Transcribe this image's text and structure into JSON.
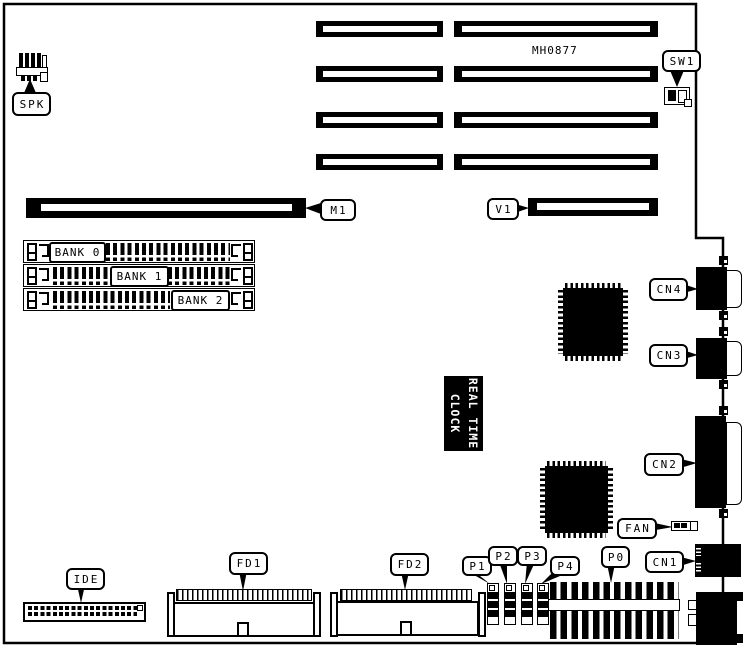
{
  "figure": {
    "board_code": "MH0877",
    "rtc": {
      "line1": "REAL TIME",
      "line2": "CLOCK"
    },
    "connector_labels": {
      "spk": "SPK",
      "sw1": "SW1",
      "m1": "M1",
      "v1": "V1",
      "cn4": "CN4",
      "cn3": "CN3",
      "cn2": "CN2",
      "cn1": "CN1",
      "fan": "FAN",
      "p0": "P0",
      "p1": "P1",
      "p2": "P2",
      "p3": "P3",
      "p4": "P4",
      "fd1": "FD1",
      "fd2": "FD2",
      "ide": "IDE"
    },
    "memory_banks": {
      "bank0": "BANK 0",
      "bank1": "BANK 1",
      "bank2": "BANK 2"
    }
  }
}
